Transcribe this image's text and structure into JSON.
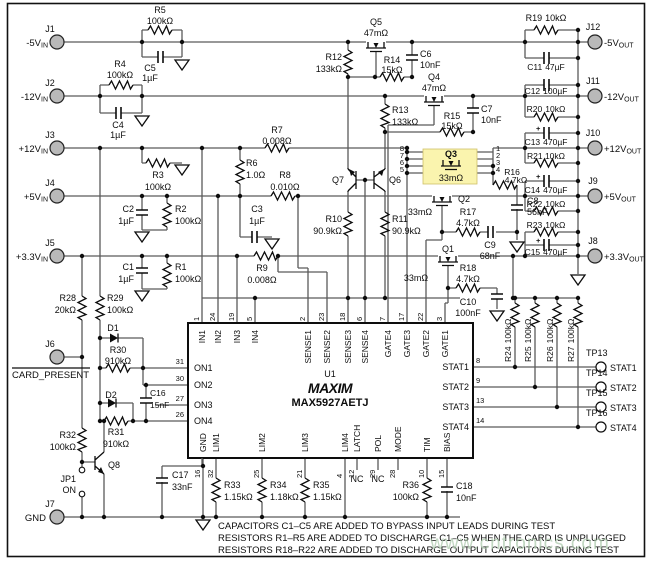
{
  "io": {
    "sub_in": "IN",
    "sub_out": "OUT",
    "plus": "+",
    "in": [
      {
        "ref": "J1",
        "v": "-5V"
      },
      {
        "ref": "J2",
        "v": "-12V"
      },
      {
        "ref": "J3",
        "v": "+12V"
      },
      {
        "ref": "J4",
        "v": "+5V"
      },
      {
        "ref": "J5",
        "v": "+3.3V"
      }
    ],
    "card": {
      "ref": "J6",
      "label": "CARD_PRESENT"
    },
    "gnd": {
      "ref": "J7",
      "label": "GND"
    },
    "out": [
      {
        "ref": "J12",
        "v": "-5V"
      },
      {
        "ref": "J11",
        "v": "-12V"
      },
      {
        "ref": "J10",
        "v": "+12V"
      },
      {
        "ref": "J9",
        "v": "+5V"
      },
      {
        "ref": "J8",
        "v": "+3.3V"
      }
    ]
  },
  "tp": [
    {
      "ref": "TP13",
      "sig": "STAT1"
    },
    {
      "ref": "TP14",
      "sig": "STAT2"
    },
    {
      "ref": "TP15",
      "sig": "STAT3"
    },
    {
      "ref": "TP16",
      "sig": "STAT4"
    }
  ],
  "parts": {
    "r1": {
      "ref": "R1",
      "val": "100kΩ"
    },
    "r2": {
      "ref": "R2",
      "val": "100kΩ"
    },
    "r3": {
      "ref": "R3",
      "val": "100kΩ"
    },
    "r4": {
      "ref": "R4",
      "val": "100kΩ"
    },
    "r5": {
      "ref": "R5",
      "val": "100kΩ"
    },
    "r6": {
      "ref": "R6",
      "val": "1.0Ω"
    },
    "r7": {
      "ref": "R7",
      "val": "0.008Ω"
    },
    "r8": {
      "ref": "R8",
      "val": "0.010Ω"
    },
    "r9": {
      "ref": "R9",
      "val": "0.008Ω"
    },
    "r10": {
      "ref": "R10",
      "val": "90.9kΩ"
    },
    "r11": {
      "ref": "R11",
      "val": "90.9kΩ"
    },
    "r12": {
      "ref": "R12",
      "val": "133kΩ"
    },
    "r13": {
      "ref": "R13",
      "val": "133kΩ"
    },
    "r14": {
      "ref": "R14",
      "val": "15kΩ"
    },
    "r15": {
      "ref": "R15",
      "val": "15kΩ"
    },
    "r16": {
      "ref": "R16",
      "val": "4.7kΩ"
    },
    "r17": {
      "ref": "R17",
      "val": "4.7kΩ"
    },
    "r18": {
      "ref": "R18",
      "val": "4.7kΩ"
    },
    "r19": {
      "ref": "R19",
      "val": "10kΩ"
    },
    "r20": {
      "ref": "R20",
      "val": "10kΩ"
    },
    "r21": {
      "ref": "R21",
      "val": "10kΩ"
    },
    "r22": {
      "ref": "R22",
      "val": "10kΩ"
    },
    "r23": {
      "ref": "R23",
      "val": "10kΩ"
    },
    "r24": {
      "ref": "R24",
      "val": "100kΩ"
    },
    "r25": {
      "ref": "R25",
      "val": "100kΩ"
    },
    "r26": {
      "ref": "R26",
      "val": "100kΩ"
    },
    "r27": {
      "ref": "R27",
      "val": "100kΩ"
    },
    "r28": {
      "ref": "R28",
      "val": "20kΩ"
    },
    "r29": {
      "ref": "R29",
      "val": "100kΩ"
    },
    "r30": {
      "ref": "R30",
      "val": "910kΩ"
    },
    "r31": {
      "ref": "R31",
      "val": "910kΩ"
    },
    "r32": {
      "ref": "R32",
      "val": "100kΩ"
    },
    "r33": {
      "ref": "R33",
      "val": "1.15kΩ"
    },
    "r34": {
      "ref": "R34",
      "val": "1.18kΩ"
    },
    "r35": {
      "ref": "R35",
      "val": "1.15kΩ"
    },
    "r36": {
      "ref": "R36",
      "val": "100kΩ"
    },
    "c1": {
      "ref": "C1",
      "val": "1µF"
    },
    "c2": {
      "ref": "C2",
      "val": "1µF"
    },
    "c3": {
      "ref": "C3",
      "val": "1µF"
    },
    "c4": {
      "ref": "C4",
      "val": "1µF"
    },
    "c5": {
      "ref": "C5",
      "val": "1µF"
    },
    "c6": {
      "ref": "C6",
      "val": "10nF"
    },
    "c7": {
      "ref": "C7",
      "val": "10nF"
    },
    "c8": {
      "ref": "C8",
      "val": "56nF"
    },
    "c9": {
      "ref": "C9",
      "val": "68nF"
    },
    "c10": {
      "ref": "C10",
      "val": "100nF"
    },
    "c11": {
      "ref": "C11",
      "val": "47µF"
    },
    "c12": {
      "ref": "C12",
      "val": "100µF"
    },
    "c13": {
      "ref": "C13",
      "val": "470µF"
    },
    "c14": {
      "ref": "C14",
      "val": "470µF"
    },
    "c15": {
      "ref": "C15",
      "val": "470µF"
    },
    "c16": {
      "ref": "C16",
      "val": "15nF"
    },
    "c17": {
      "ref": "C17",
      "val": "33nF"
    },
    "c18": {
      "ref": "C18",
      "val": "10nF"
    },
    "q1": {
      "ref": "Q1",
      "val": "33mΩ"
    },
    "q2": {
      "ref": "Q2",
      "val": "33mΩ"
    },
    "q3": {
      "ref": "Q3",
      "val": "33mΩ",
      "pins_l": [
        "8",
        "7",
        "6",
        "5"
      ],
      "pins_r": [
        "1",
        "2",
        "3",
        "4"
      ]
    },
    "q4": {
      "ref": "Q4",
      "val": "47mΩ"
    },
    "q5": {
      "ref": "Q5",
      "val": "47mΩ"
    },
    "q6": {
      "ref": "Q6"
    },
    "q7": {
      "ref": "Q7"
    },
    "q8": {
      "ref": "Q8"
    },
    "d1": {
      "ref": "D1"
    },
    "d2": {
      "ref": "D2"
    },
    "jp1": {
      "ref": "JP1",
      "mode": "ON"
    }
  },
  "ic": {
    "ref": "U1",
    "brand": "MAXIM",
    "part": "MAX5927AETJ",
    "nc": "NC",
    "top": [
      {
        "num": "1",
        "name": "IN1"
      },
      {
        "num": "24",
        "name": "IN2"
      },
      {
        "num": "19",
        "name": "IN3"
      },
      {
        "num": "5",
        "name": "IN4"
      },
      {
        "num": "2",
        "name": "SENSE1"
      },
      {
        "num": "23",
        "name": "SENSE2"
      },
      {
        "num": "18",
        "name": "SENSE3"
      },
      {
        "num": "6",
        "name": "SENSE4"
      },
      {
        "num": "7",
        "name": "GATE4"
      },
      {
        "num": "17",
        "name": "GATE3"
      },
      {
        "num": "22",
        "name": "GATE2"
      },
      {
        "num": "3",
        "name": "GATE1"
      }
    ],
    "left": [
      {
        "num": "31",
        "name": "ON1"
      },
      {
        "num": "30",
        "name": "ON2"
      },
      {
        "num": "27",
        "name": "ON3"
      },
      {
        "num": "26",
        "name": "ON4"
      }
    ],
    "right": [
      {
        "num": "8",
        "name": "STAT1"
      },
      {
        "num": "9",
        "name": "STAT2"
      },
      {
        "num": "13",
        "name": "STAT3"
      },
      {
        "num": "14",
        "name": "STAT4"
      }
    ],
    "bottom": [
      {
        "num": "16",
        "name": "GND"
      },
      {
        "num": "32",
        "name": "LIM1"
      },
      {
        "num": "25",
        "name": "LIM2"
      },
      {
        "num": "21",
        "name": "LIM3"
      },
      {
        "num": "4",
        "name": "LIM4"
      },
      {
        "num": "12",
        "name": "LATCH"
      },
      {
        "num": "29",
        "name": "POL"
      },
      {
        "num": "28",
        "name": "MODE"
      },
      {
        "num": "10",
        "name": "TIM"
      },
      {
        "num": "15",
        "name": "BIAS"
      }
    ]
  },
  "notes": [
    "CAPACITORS C1–C5 ARE ADDED TO BYPASS INPUT LEADS DURING TEST",
    "RESISTORS R1–R5 ARE ADDED TO DISCHARGE C1–C5 WHEN THE CARD IS UNPLUGGED",
    "RESISTORS R18–R22 ARE ADDED TO DISCHARGE OUTPUT CAPACITORS DURING TEST"
  ],
  "watermark": "www.cntronics.com",
  "colors": {
    "highlight": "#faf4ae",
    "connector": "#b9b9b9"
  }
}
